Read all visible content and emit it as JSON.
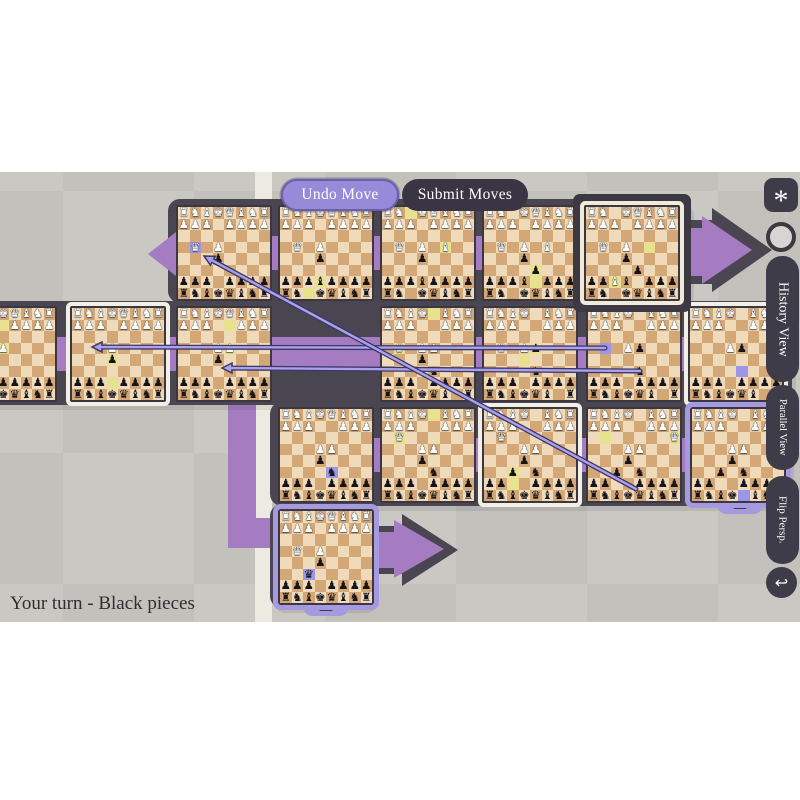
{
  "toolbar": {
    "undo": "Undo Move",
    "submit": "Submit Moves"
  },
  "sidebar": {
    "star": "*",
    "history": "History View",
    "parallel": "Parallel View",
    "flip": "Flip Persp.",
    "undo_icon": "↩"
  },
  "status": {
    "text": "Your turn - Black pieces"
  },
  "colors": {
    "purple": "#a57cc2",
    "bar": "#494652",
    "light_sq": "#efdaba",
    "dark_sq": "#d3a876",
    "hl_yellow": "#e8e18f",
    "hl_lavender": "#9d95e6",
    "arrow_line": "#aaa3ea",
    "arrow_outline": "#3c3768",
    "cream_border": "#f2efe4",
    "lavender_border": "#a59ae0",
    "strip": "#edebe1"
  },
  "glyphs": {
    "K": "♚",
    "Q": "♛",
    "R": "♜",
    "B": "♝",
    "N": "♞",
    "P": "♟"
  },
  "boards": [
    {
      "id": "t2-move1",
      "x": -39,
      "y": 134,
      "border": "none",
      "rows": [
        "RNBKQBNR",
        "PPP.PPPP",
        "........",
        "...P....",
        "........",
        "........",
        "pppppppp",
        "rnbkqbnr"
      ],
      "hl": [
        [
          2,
          4,
          "y"
        ],
        [
          4,
          4,
          "y"
        ]
      ]
    },
    {
      "id": "t2-move2",
      "x": 70,
      "y": 134,
      "border": "cream",
      "rows": [
        "RNBKQBNR",
        "PPP.PPPP",
        "........",
        "...P....",
        "...p....",
        "........",
        "ppp.pppp",
        "rnbkqbnr"
      ],
      "hl": [
        [
          7,
          4,
          "y"
        ],
        [
          5,
          4,
          "y"
        ]
      ]
    },
    {
      "id": "t2-move3",
      "x": 176,
      "y": 134,
      "border": "none",
      "rows": [
        "RNBKQBNR",
        "PPP..PPP",
        "........",
        "...PP...",
        "...p....",
        "........",
        "ppp.pppp",
        "rnbkqbnr"
      ],
      "hl": [
        [
          2,
          5,
          "y"
        ],
        [
          4,
          5,
          "y"
        ]
      ]
    },
    {
      "id": "t2-move4",
      "x": 380,
      "y": 134,
      "border": "none",
      "rows": [
        "RNBK.BNR",
        "PPP..PPP",
        "........",
        ".Q.PP...",
        "...p....",
        "....n...",
        "ppp.pppp",
        "rnbkqb.r"
      ],
      "hl": [
        [
          1,
          5,
          "y"
        ],
        [
          4,
          2,
          "y"
        ]
      ]
    },
    {
      "id": "t2-move5",
      "x": 482,
      "y": 134,
      "border": "none",
      "rows": [
        "RNBK.BNR",
        "PPP..PPP",
        "........",
        ".Q.Pp...",
        "........",
        "....n...",
        "ppp.pppp",
        "rnbkqb.r"
      ],
      "hl": [
        [
          4,
          5,
          "y"
        ],
        [
          5,
          4,
          "y"
        ]
      ]
    },
    {
      "id": "t2-move6",
      "x": 586,
      "y": 134,
      "border": "none",
      "rows": [
        "RNBK.BNR",
        "PPP..PPP",
        "........",
        "...Pp...",
        "........",
        "....n...",
        "ppp.pppp",
        "rnbkqb.r"
      ],
      "hl": [
        [
          4,
          2,
          "v"
        ]
      ]
    },
    {
      "id": "t2-move7",
      "x": 688,
      "y": 134,
      "border": "cream",
      "rows": [
        "RNBK.BNR",
        "PPP..PPP",
        "........",
        "...Pp...",
        "........",
        "........",
        "ppp.pppp",
        "rnbkqb.r"
      ],
      "hl": [
        [
          6,
          5,
          "v"
        ]
      ]
    },
    {
      "id": "t1-move1",
      "x": 176,
      "y": 33,
      "border": "none",
      "rows": [
        "RNBKQBNR",
        "PPP.PPPP",
        "........",
        ".Q.P....",
        "...p....",
        "........",
        "ppp.pppp",
        "rnbkqbnr"
      ],
      "hl": [
        [
          4,
          2,
          "v"
        ]
      ]
    },
    {
      "id": "t1-move2",
      "x": 278,
      "y": 33,
      "border": "none",
      "rows": [
        "RNBKQBNR",
        "PPP.PPPP",
        "........",
        ".Q.P....",
        "...p....",
        "........",
        "pppbpppp",
        "rn.kqbnr"
      ],
      "hl": [
        [
          8,
          3,
          "y"
        ],
        [
          7,
          4,
          "y"
        ]
      ]
    },
    {
      "id": "t1-move3",
      "x": 380,
      "y": 33,
      "border": "none",
      "rows": [
        "RN.KQBNR",
        "PPP.PPPP",
        "........",
        ".Q.P.B..",
        "...p....",
        "........",
        "pppbpppp",
        "rn.kqbnr"
      ],
      "hl": [
        [
          1,
          3,
          "y"
        ],
        [
          4,
          6,
          "y"
        ]
      ]
    },
    {
      "id": "t1-move4",
      "x": 482,
      "y": 33,
      "border": "none",
      "rows": [
        "RN.KQBNR",
        "PPP.PPPP",
        "........",
        ".Q.P.B..",
        "...p....",
        "....p...",
        "pppb.ppp",
        "rn.kqbnr"
      ],
      "hl": [
        [
          7,
          5,
          "y"
        ],
        [
          6,
          5,
          "y"
        ]
      ]
    },
    {
      "id": "t1-move5",
      "x": 584,
      "y": 33,
      "border": "active",
      "rows": [
        "RN.KQBNR",
        "PPP.PPPP",
        "........",
        ".Q.P....",
        "...p....",
        "....p...",
        "ppBb.ppp",
        "rn.kqbnr"
      ],
      "hl": [
        [
          4,
          6,
          "y"
        ],
        [
          7,
          3,
          "y"
        ]
      ]
    },
    {
      "id": "t3-move1",
      "x": 278,
      "y": 235,
      "border": "none",
      "rows": [
        "RNBKQBNR",
        "PPP..PPP",
        "........",
        "...PP...",
        "...p....",
        "....n...",
        "ppp.pppp",
        "rnbkqbnr"
      ],
      "hl": [
        [
          6,
          5,
          "v"
        ]
      ]
    },
    {
      "id": "t3-move2",
      "x": 380,
      "y": 235,
      "border": "none",
      "rows": [
        "RNBK.BNR",
        "PPP..PPP",
        ".Q......",
        "...PP...",
        "...p....",
        "....n...",
        "ppp.pppp",
        "rnbkqbnr"
      ],
      "hl": [
        [
          1,
          5,
          "y"
        ],
        [
          3,
          2,
          "y"
        ]
      ]
    },
    {
      "id": "t3-move3",
      "x": 482,
      "y": 235,
      "border": "cream",
      "rows": [
        "RNBK.BNR",
        "PPP..PPP",
        ".Q......",
        "...PP...",
        "...p....",
        "..p.n...",
        "pp..pppp",
        "rnbkqbnr"
      ],
      "hl": [
        [
          7,
          3,
          "y"
        ],
        [
          6,
          3,
          "y"
        ]
      ]
    },
    {
      "id": "t3-move4",
      "x": 586,
      "y": 235,
      "border": "none",
      "rows": [
        "RNBK.BNR",
        "PPP..PPP",
        ".......Q",
        "...PP...",
        "...p....",
        "..p.n...",
        "pp..pppp",
        "rnbkqbnr"
      ],
      "hl": [
        [
          3,
          2,
          "y"
        ],
        [
          3,
          8,
          "y"
        ]
      ]
    },
    {
      "id": "t3-move5",
      "x": 690,
      "y": 235,
      "border": "lavender",
      "rows": [
        "RNBK.BNR",
        "PPP..PPP",
        ".......Q",
        "...PP...",
        "...p....",
        "..p.n...",
        "pp..pppp",
        "rnbk.bnr"
      ],
      "hl": [
        [
          8,
          5,
          "v"
        ]
      ]
    },
    {
      "id": "t4-move1",
      "x": 278,
      "y": 337,
      "border": "lavender",
      "rows": [
        "RNBKQBNR",
        "PPP.PPPP",
        "........",
        ".Q.P....",
        "...p....",
        "..q.....",
        "ppp.pppp",
        "rnbkqbnr"
      ],
      "hl": [
        [
          6,
          3,
          "v"
        ]
      ]
    }
  ],
  "move_arrows": [
    {
      "x1": 605,
      "y1": 176,
      "x2": 92,
      "y2": 175
    },
    {
      "x1": 640,
      "y1": 199,
      "x2": 222,
      "y2": 196
    },
    {
      "x1": 636,
      "y1": 317,
      "x2": 204,
      "y2": 84
    }
  ]
}
